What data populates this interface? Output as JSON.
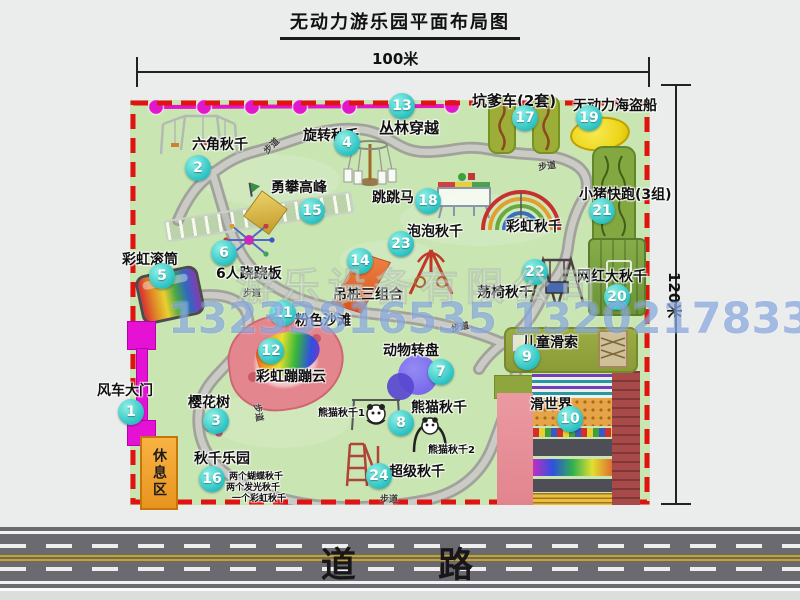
{
  "title": "无动力游乐园平面布局图",
  "dimensions": {
    "width": "100米",
    "height": "120米"
  },
  "road_label": "道 路",
  "walkway_label": "步道",
  "rest_area": "休息区",
  "watermark": {
    "company": "游乐设备有限公司",
    "phones": "13233816535 13202178333"
  },
  "colors": {
    "map_green": "#c9e5b2",
    "border_red": "#e01212",
    "badge_teal": "#2cc2c2",
    "zipline_magenta": "#e018ca",
    "gate_magenta": "#e512d6",
    "rest_orange": "#f09a28",
    "road_gray": "#6a6a70"
  },
  "attractions": {
    "windmill_gate": {
      "num": "1",
      "name": "风车大门"
    },
    "hex_swing": {
      "num": "2",
      "name": "六角秋千"
    },
    "cherry_tree": {
      "num": "3",
      "name": "樱花树"
    },
    "rotating_swing": {
      "num": "4",
      "name": "旋转秋千"
    },
    "rainbow_roller": {
      "num": "5",
      "name": "彩虹滚筒"
    },
    "seesaw6": {
      "num": "6",
      "name": "6人跷跷板"
    },
    "animal_turntable": {
      "num": "7",
      "name": "动物转盘"
    },
    "panda_swing": {
      "num": "8",
      "name": "熊猫秋千",
      "sub1": "熊猫秋千1",
      "sub2": "熊猫秋千2"
    },
    "kids_zipline": {
      "num": "9",
      "name": "儿童滑索"
    },
    "slide_world": {
      "num": "10",
      "name": "滑世界"
    },
    "pink_beach": {
      "num": "11",
      "name": "粉色沙滩"
    },
    "rainbow_cloud": {
      "num": "12",
      "name": "彩虹蹦蹦云"
    },
    "jungle_crossing": {
      "num": "13",
      "name": "丛林穿越"
    },
    "hanging_piles": {
      "num": "14",
      "name": "吊桩三组合"
    },
    "climbing_peak": {
      "num": "15",
      "name": "勇攀高峰"
    },
    "swing_park": {
      "num": "16",
      "name": "秋千乐园",
      "items": [
        "两个蝴蝶秋千",
        "两个发光秋千",
        "一个彩虹秋千"
      ]
    },
    "pit_cart": {
      "num": "17",
      "name": "坑爹车(2套)"
    },
    "jumping_horse": {
      "num": "18",
      "name": "跳跳马"
    },
    "pirate_ship": {
      "num": "19",
      "name": "无动力海盗船"
    },
    "big_swing": {
      "num": "20",
      "name": "网红大秋千"
    },
    "pig_run": {
      "num": "21",
      "name": "小猪快跑(3组)"
    },
    "chair_swing": {
      "num": "22",
      "name": "荡椅秋千"
    },
    "bubble_swing": {
      "num": "23",
      "name": "泡泡秋千"
    },
    "super_swing": {
      "num": "24",
      "name": "超级秋千"
    },
    "rainbow_swing": {
      "num": "",
      "name": "彩虹秋千"
    }
  }
}
